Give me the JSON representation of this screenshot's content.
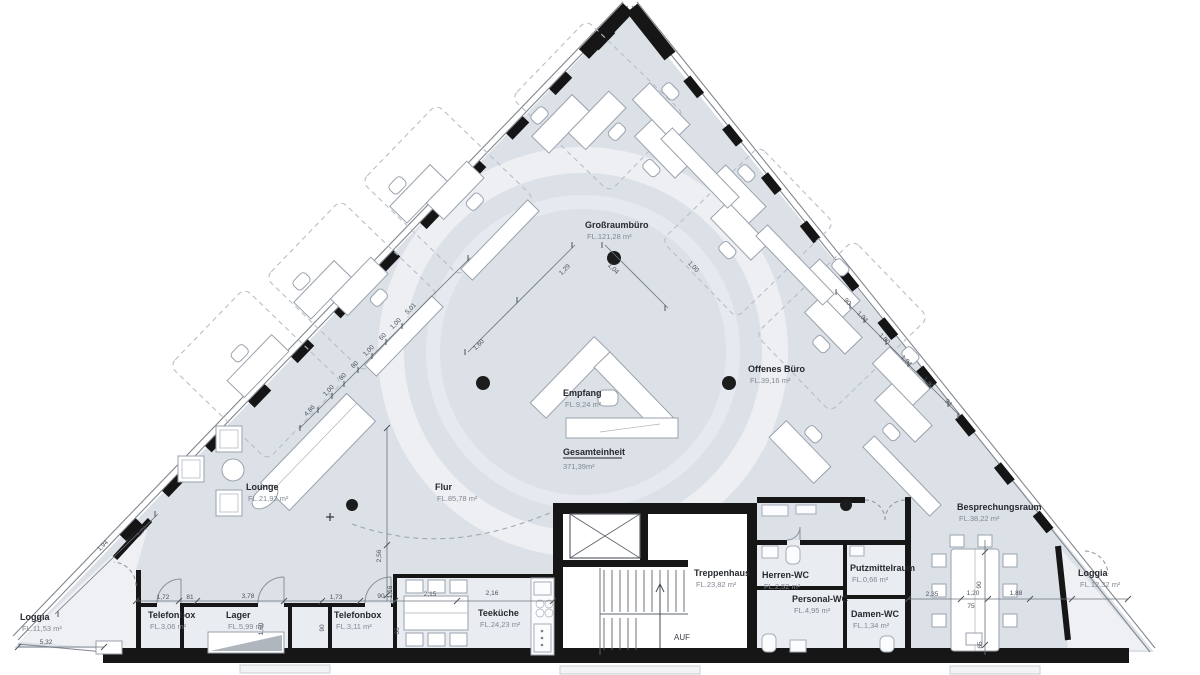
{
  "rooms": [
    {
      "name": "Großraumbüro",
      "area": "FL.121,28 m²"
    },
    {
      "name": "Offenes Büro",
      "area": "FL.39,16 m²"
    },
    {
      "name": "Empfang",
      "area": "FL.9,24 m²"
    },
    {
      "name": "Lounge",
      "area": "FL.21,92 m²"
    },
    {
      "name": "Flur",
      "area": "FL.85,78 m²"
    },
    {
      "name": "Loggia",
      "area": "FL.11,53 m²"
    },
    {
      "name": "Telefonbox",
      "area": "FL.3,06 m²"
    },
    {
      "name": "Lager",
      "area": "FL.5,99 m²"
    },
    {
      "name": "Telefonbox",
      "area": "FL.3,11 m²"
    },
    {
      "name": "Teeküche",
      "area": "FL.24,23 m²"
    },
    {
      "name": "Treppenhaus",
      "area": "FL.23,82 m²"
    },
    {
      "name": "Herren-WC",
      "area": "FL.2,52 m²"
    },
    {
      "name": "Personal-WC",
      "area": "FL.4,95 m²"
    },
    {
      "name": "Putzmittelraum",
      "area": "FL.0,66 m²"
    },
    {
      "name": "Damen-WC",
      "area": "FL.1,34 m²"
    },
    {
      "name": "Besprechungsraum",
      "area": "FL.38,22 m²"
    },
    {
      "name": "Loggia",
      "area": "FL.12,32 m²"
    }
  ],
  "summary": {
    "label": "Gesamteinheit",
    "value": "371,39m²"
  },
  "stairs_label": "AUF",
  "dims": [
    "5,32",
    "1,72",
    "81",
    "3,78",
    "1,73",
    "90",
    "2,15",
    "2,16",
    "2,35",
    "1,20",
    "75",
    "1,88",
    "1,94",
    "1,74",
    "1,60",
    "90",
    "2,56",
    "1,16",
    "66",
    "90",
    "65",
    "1,29",
    "1,04",
    "1,60",
    "4,86",
    "1,00",
    "80",
    "80",
    "1,00",
    "60",
    "1,00",
    "5,01",
    "90",
    "1,04",
    "1,80",
    "1,04",
    "1,80",
    "94",
    "1,00"
  ],
  "colors": {
    "interior_fill": "#dce1e8",
    "service_room_fill": "#e9edf2",
    "loggia_fill": "#eef0f3",
    "core_fill": "#ffffff",
    "wall": "#161616",
    "furniture_stroke": "#99a2ac",
    "dashed_zone": "#b7bec9",
    "dimension_text": "#4c5259",
    "room_label": "#26292e",
    "area_label": "#818892"
  }
}
